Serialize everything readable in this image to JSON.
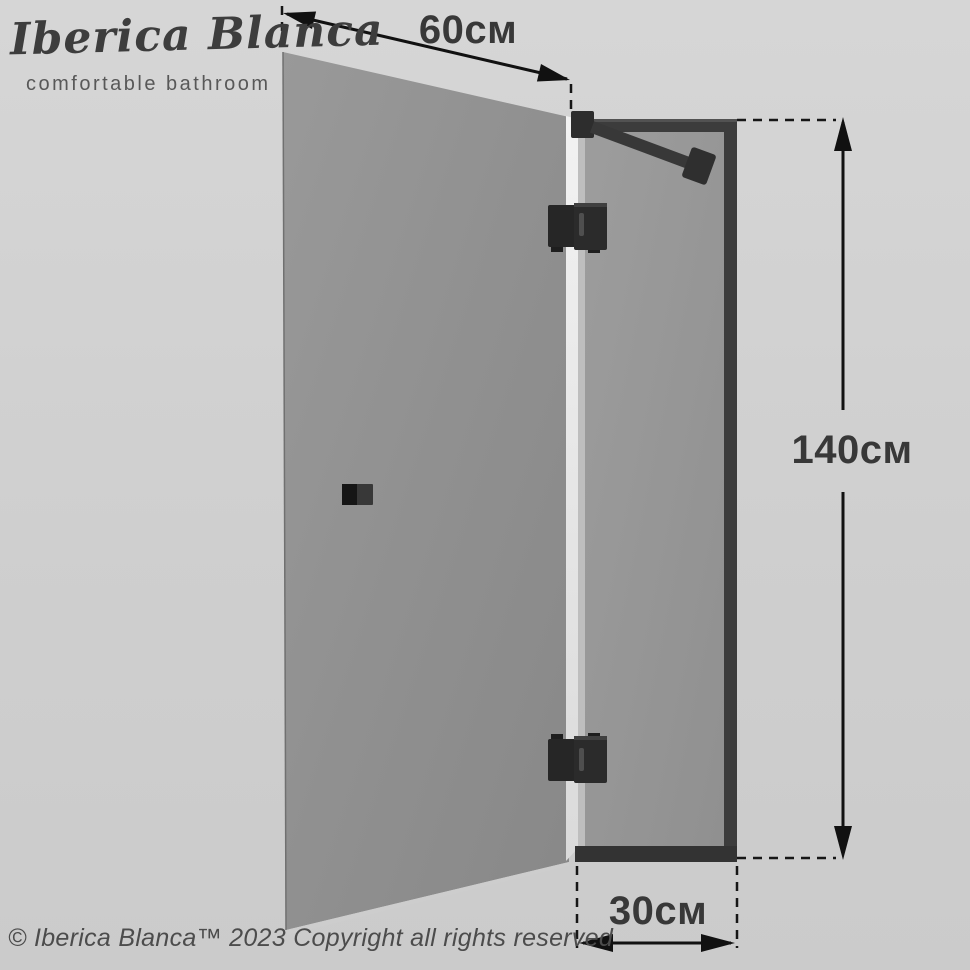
{
  "brand": {
    "name": "Iberica Blanca",
    "tagline": "comfortable bathroom"
  },
  "diagram": {
    "product": "hinged shower door with fixed side panel",
    "dimensions": {
      "door_width": "60см",
      "panel_height": "140см",
      "panel_width": "30см"
    }
  },
  "footer": {
    "copyright": "© Iberica Blanca™ 2023 Copyright all rights reserved"
  },
  "colors": {
    "background": "#d0d0d0",
    "door_glass": "#8f8f8f",
    "panel_glass": "#979797",
    "glass_edge": "#e9e9e9",
    "frame": "#3a3a3a",
    "hardware": "#262626",
    "dimension_lines": "#141414",
    "label_text": "#383838"
  }
}
